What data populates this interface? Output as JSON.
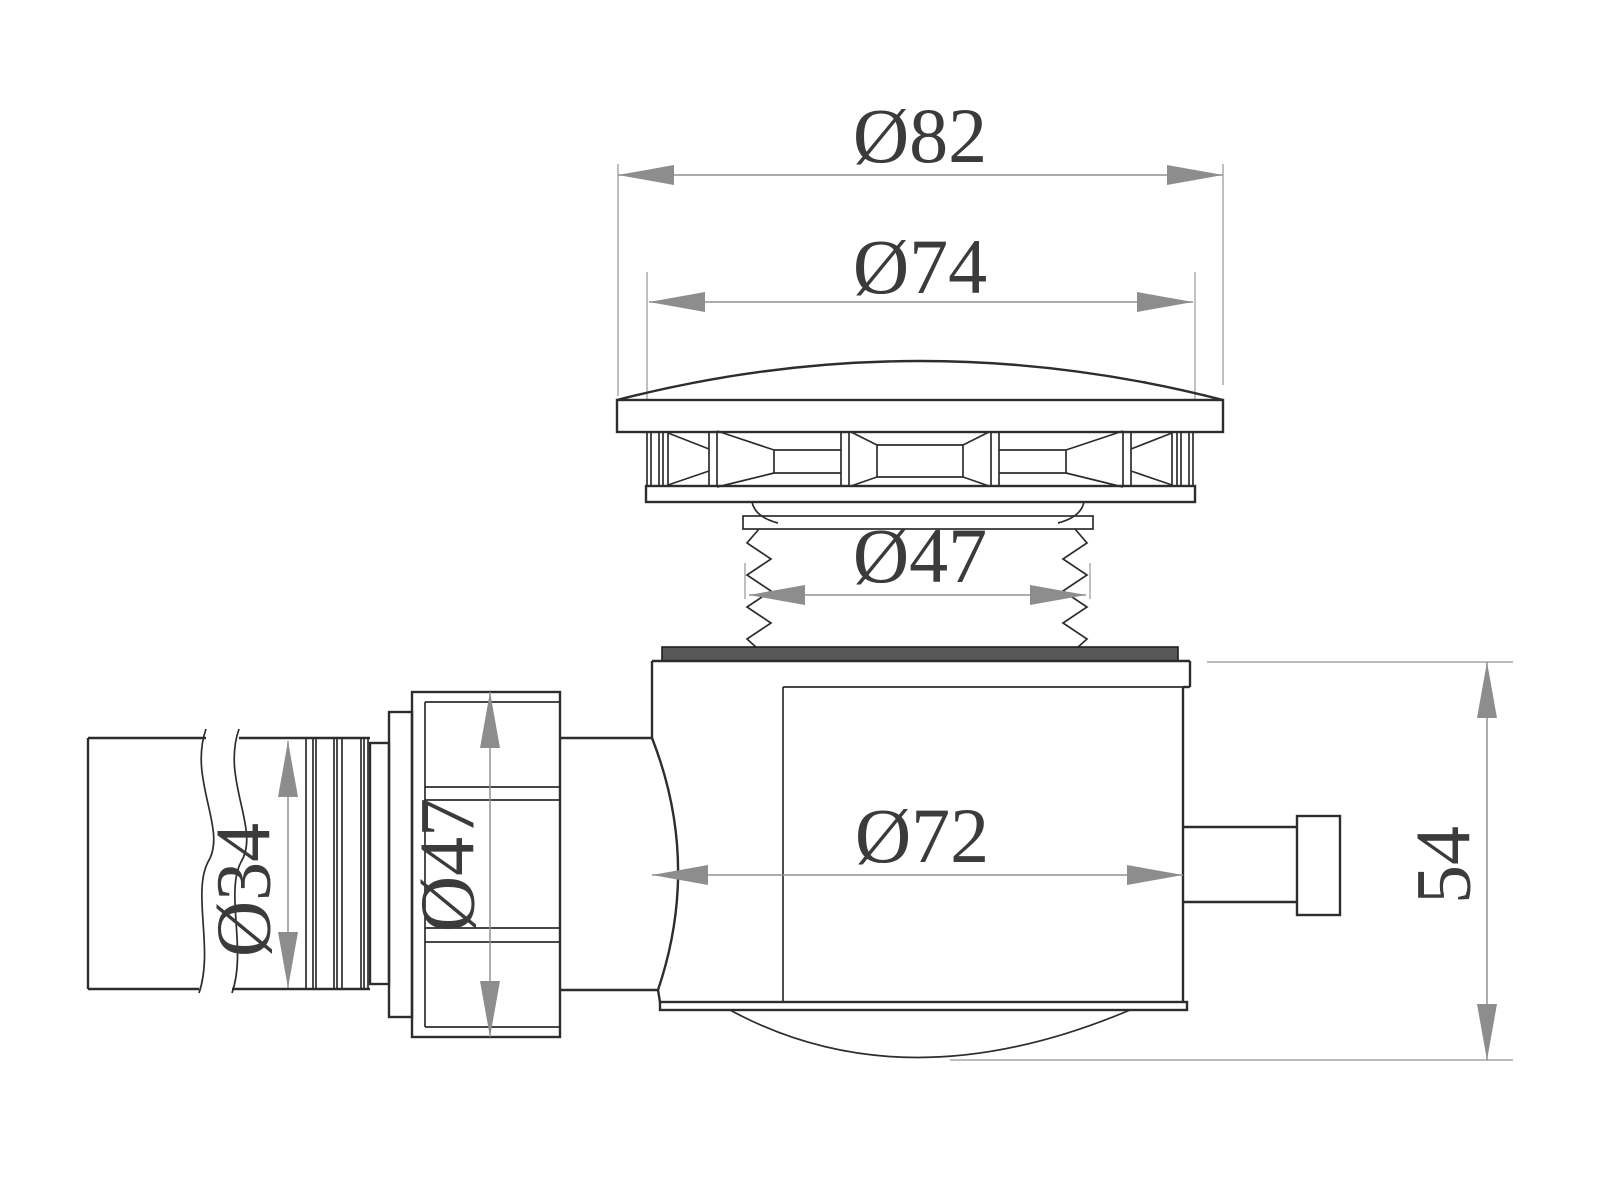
{
  "drawing": {
    "labels": {
      "dim_cap_outer": "Ø82",
      "dim_cap_face": "Ø74",
      "dim_thread": "Ø47",
      "dim_body": "Ø72",
      "dim_inlet_pipe": "Ø34",
      "dim_nut": "Ø47",
      "dim_height": "54"
    },
    "colors": {
      "background": "#ffffff",
      "outline": "#2d2d2d",
      "dimension_lines": "#909090",
      "gasket_fill": "#575757",
      "label_text": "#3b3b3b"
    }
  }
}
